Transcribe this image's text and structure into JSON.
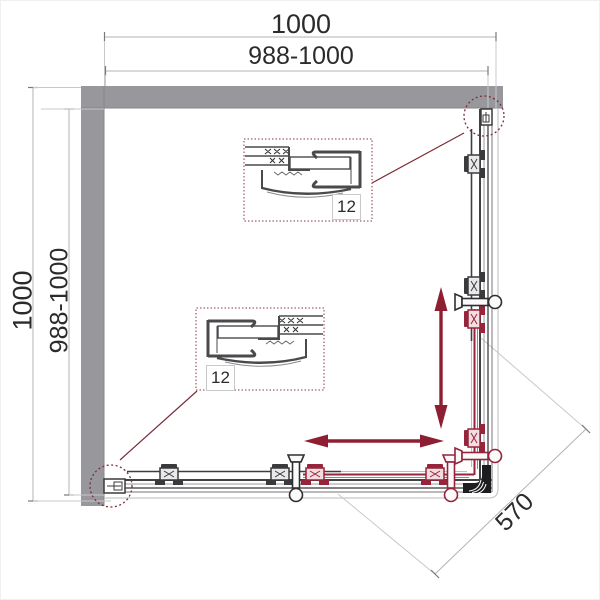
{
  "diagram": {
    "dimensions": {
      "width_outer": "1000",
      "width_inner": "988-1000",
      "height_outer": "1000",
      "height_inner": "988-1000",
      "entry_diagonal": "570"
    },
    "detail_callouts": [
      {
        "label": "12"
      },
      {
        "label": "12"
      }
    ],
    "colors": {
      "wall_gray": "#98989c",
      "frame_dark": "#3e3e40",
      "frame_light": "#c6c6c8",
      "accent_red": "#96243a",
      "callout_red": "#7b2d38",
      "text": "#2b2b2d",
      "background": "#ffffff"
    }
  }
}
